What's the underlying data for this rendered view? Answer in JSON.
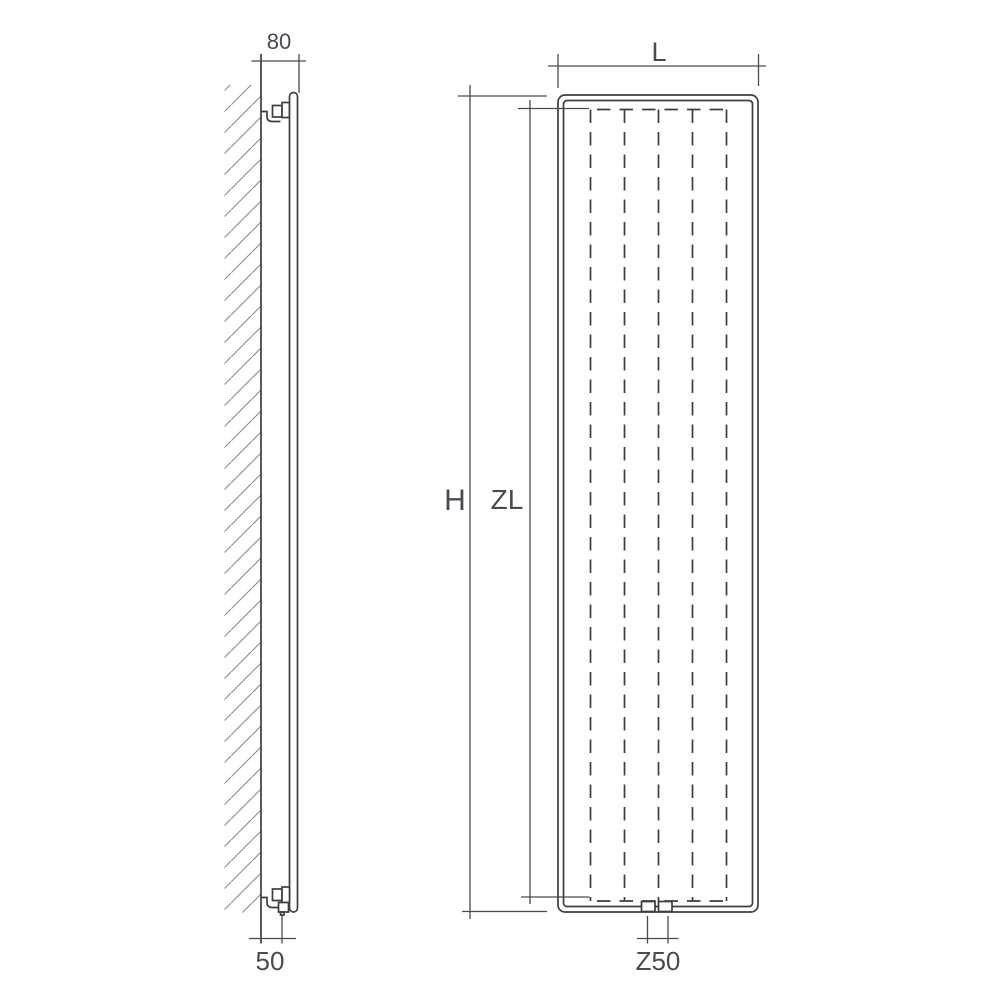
{
  "diagram": {
    "kind": "radiator-dimension-drawing",
    "side_view": {
      "depth_top_label": "80",
      "depth_bottom_label": "50"
    },
    "front_view": {
      "width_label": "L",
      "height_label": "H",
      "inner_height_label": "ZL",
      "connection_label": "Z50"
    },
    "colors": {
      "line": "#3d3d42",
      "dimension_line": "#4a4a50",
      "text": "#4a4a53",
      "hatch": "#8a8a8a",
      "background": "#ffffff"
    }
  }
}
